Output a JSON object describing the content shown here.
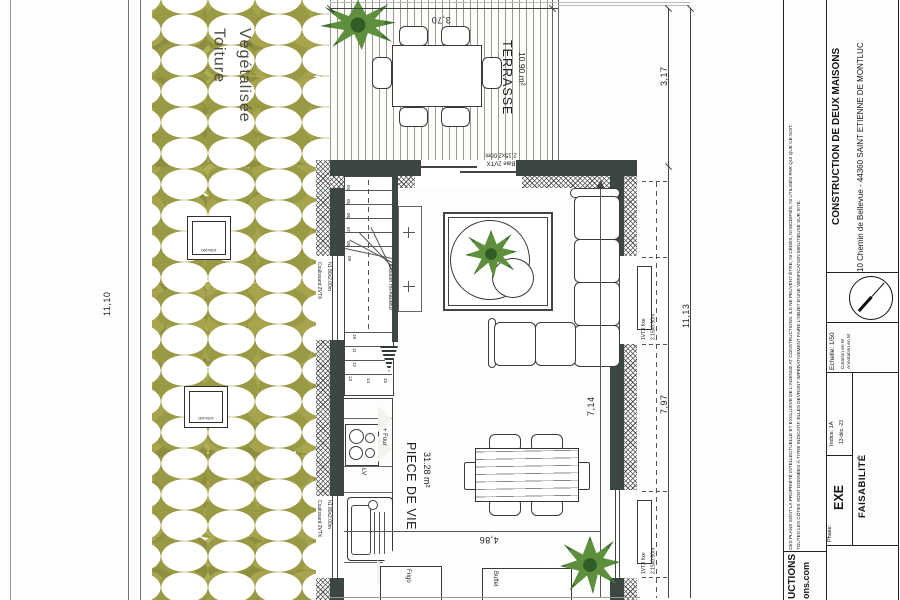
{
  "plan": {
    "roof_label": {
      "line1": "Toiture",
      "line2": "Végétalisée"
    },
    "skylight_label": "100x100",
    "rooms": {
      "terrasse": {
        "name": "TERRASSE",
        "area": "10.90 m²"
      },
      "piece_de_vie": {
        "name": "PIECE DE VIE",
        "area": "31.28 m²"
      }
    },
    "openings": {
      "baie": {
        "line1": "Baie 2VTX",
        "line2": "2.15x2.00m"
      },
      "fixed_window": {
        "line1": "1VTX fixe",
        "line2": "2.15x0.90m"
      },
      "sliding": {
        "line1": "Coulissant 2VTX",
        "line2": "h1.80x2.00m"
      }
    },
    "furniture": {
      "four": "+ Four",
      "lv": "LV",
      "frigo": "Frigo",
      "buffet": "Buffet",
      "cloison": "Cloison mi-hauteur"
    },
    "stairs": {
      "numbers": [
        "04",
        "05",
        "06",
        "07",
        "08",
        "09",
        "10",
        "11",
        "12",
        "13",
        "14",
        "15"
      ]
    },
    "dimensions": {
      "terrace_width": "3,70",
      "terrace_depth": "3,17",
      "right_total": "11,13",
      "house_right": "7,97",
      "interior_length": "7,14",
      "left_total": "11,10",
      "interior_width": "4,86"
    }
  },
  "title_block": {
    "disclaimer1": "CES PLANS SONT LA PROPRIÉTÉ INTELLECTUELLE ET EXCLUSIVE DE L'AGENCE AT CONSTRUCTIONS. ILS NE PEUVENT ÊTRE, NI CÉDÉS, NI MODIFIÉS, NI UTILISÉS PAR QUI QUE CE SOIT.",
    "disclaimer2": "TOUTES LES CÔTES SONT DONNÉES À TITRE INDICATIF. ELLES DEVRONT IMPÉRATIVEMENT FAIRE L'OBJET D'UNE VÉRIFICATION MINUTIEUSE SUR SITE.",
    "project": "CONSTRUCTION DE DEUX MAISONS",
    "address": "10 Chemin de Bellevue - 44360 SAINT ETIENNE DE MONTLUC",
    "scale_label": "Echelle:",
    "scale_value": "1/50",
    "cotation": "Cotation en M",
    "annotation": "Annotation en M",
    "indice_label": "Indice:",
    "indice_value": "1A",
    "date": "13-déc.-23",
    "phase_label": "Phase:",
    "phase_value": "EXE",
    "stage": "FAISABILITÉ",
    "logo_line1": "UCTIONS",
    "logo_line2": "ons.com"
  },
  "colors": {
    "wall": "#3c4741",
    "vegetation": "#9a9944",
    "tree": "#5d8f3c",
    "ink": "#1c1c1c"
  }
}
